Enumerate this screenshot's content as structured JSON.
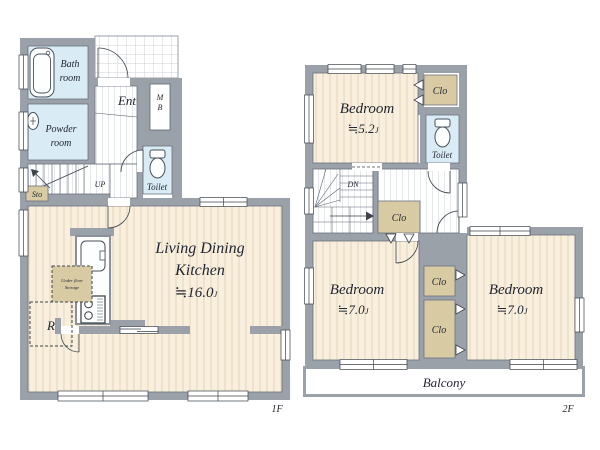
{
  "document": {
    "type": "real-estate floor plan",
    "floors_shown": [
      "1F",
      "2F"
    ]
  },
  "colors": {
    "wall": "#9aa1a9",
    "wood_floor": "#f9efde",
    "wet_area": "#d9ecf5",
    "closet": "#d8cba3",
    "line": "#3d434d",
    "background": "#ffffff"
  },
  "f1": {
    "floor_label": "1F",
    "bath": {
      "l1": "Bath",
      "l2": "room"
    },
    "powder": {
      "l1": "Powder",
      "l2": "room"
    },
    "ent": "Ent",
    "mb": {
      "l1": "M",
      "l2": "B"
    },
    "toilet": "Toilet",
    "stairs": "UP",
    "sto": "Sto",
    "ldk": {
      "l1": "Living Dining",
      "l2": "Kitchen",
      "size": "≒16.0",
      "unit": "J"
    },
    "under_floor": {
      "l1": "Under floor",
      "l2": "Storage"
    },
    "fridge": "R"
  },
  "f2": {
    "floor_label": "2F",
    "bedroom_a": {
      "name": "Bedroom",
      "size": "≒5.2",
      "unit": "J"
    },
    "bedroom_b": {
      "name": "Bedroom",
      "size": "≒7.0",
      "unit": "J"
    },
    "bedroom_c": {
      "name": "Bedroom",
      "size": "≒7.0",
      "unit": "J"
    },
    "toilet": "Toilet",
    "stairs": "DN",
    "clo_a": "Clo",
    "clo_b": "Clo",
    "clo_c": "Clo",
    "clo_d": "Clo",
    "balcony": "Balcony"
  }
}
